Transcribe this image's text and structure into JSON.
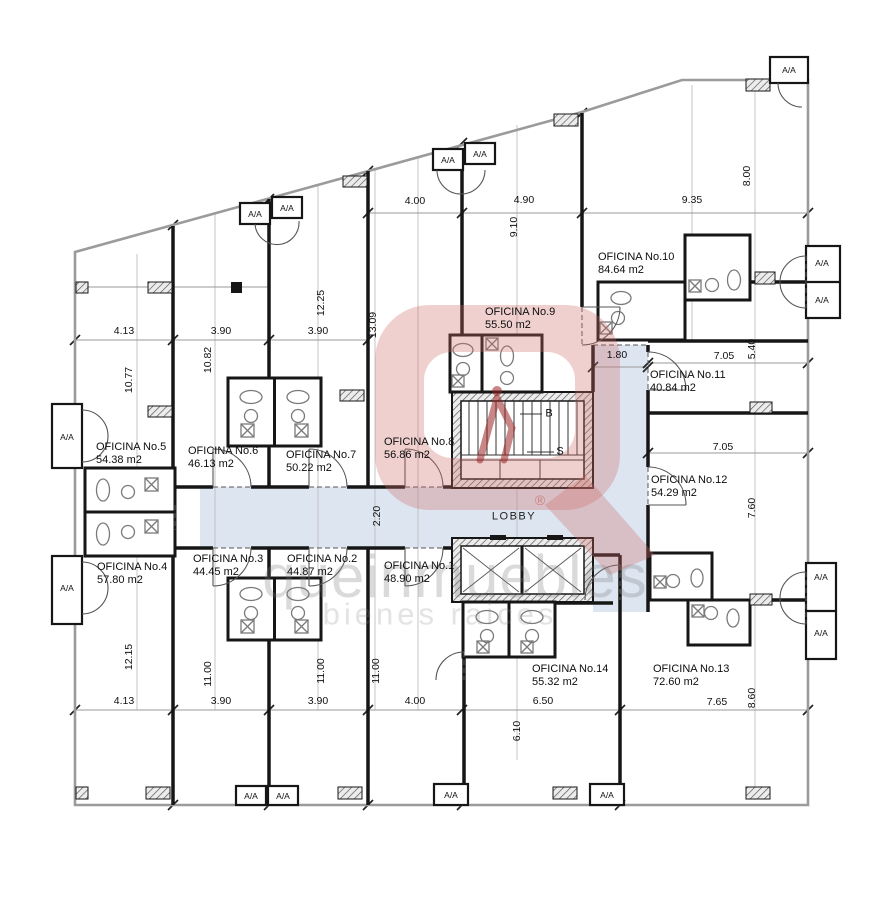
{
  "labels": {
    "ac": "A/A",
    "lobby": "LOBBY",
    "stairs_up": "B",
    "stairs_down": "S"
  },
  "watermark": {
    "brand": "queinmuebles",
    "tagline": "bienes raices",
    "registered": "®"
  },
  "offices": [
    {
      "name": "OFICINA No.1",
      "area": "48.90 m2"
    },
    {
      "name": "OFICINA No.2",
      "area": "44.87 m2"
    },
    {
      "name": "OFICINA No.3",
      "area": "44.45 m2"
    },
    {
      "name": "OFICINA No.4",
      "area": "57.80 m2"
    },
    {
      "name": "OFICINA No.5",
      "area": "54.38 m2"
    },
    {
      "name": "OFICINA No.6",
      "area": "46.13 m2"
    },
    {
      "name": "OFICINA No.7",
      "area": "50.22 m2"
    },
    {
      "name": "OFICINA No.8",
      "area": "56.86 m2"
    },
    {
      "name": "OFICINA No.9",
      "area": "55.50 m2"
    },
    {
      "name": "OFICINA No.10",
      "area": "84.64 m2"
    },
    {
      "name": "OFICINA No.11",
      "area": "40.84 m2"
    },
    {
      "name": "OFICINA No.12",
      "area": "54.29 m2"
    },
    {
      "name": "OFICINA No.13",
      "area": "72.60 m2"
    },
    {
      "name": "OFICINA No.14",
      "area": "55.32 m2"
    }
  ],
  "dims": {
    "top": [
      "4.00",
      "4.90",
      "9.35"
    ],
    "top_v": [
      "9.10",
      "8.00"
    ],
    "left_h": [
      "4.13",
      "3.90",
      "3.90"
    ],
    "left_v": [
      "10.77",
      "10.82",
      "12.25",
      "13.09"
    ],
    "mid": [
      "1.80",
      "2.20"
    ],
    "right_h": [
      "7.05",
      "7.05",
      "7.65"
    ],
    "right_v": [
      "5.40",
      "7.60",
      "8.60"
    ],
    "bottom_h": [
      "4.13",
      "3.90",
      "3.90",
      "4.00",
      "6.50"
    ],
    "bottom_v": [
      "12.15",
      "11.00",
      "11.00",
      "11.00",
      "6.10"
    ]
  }
}
